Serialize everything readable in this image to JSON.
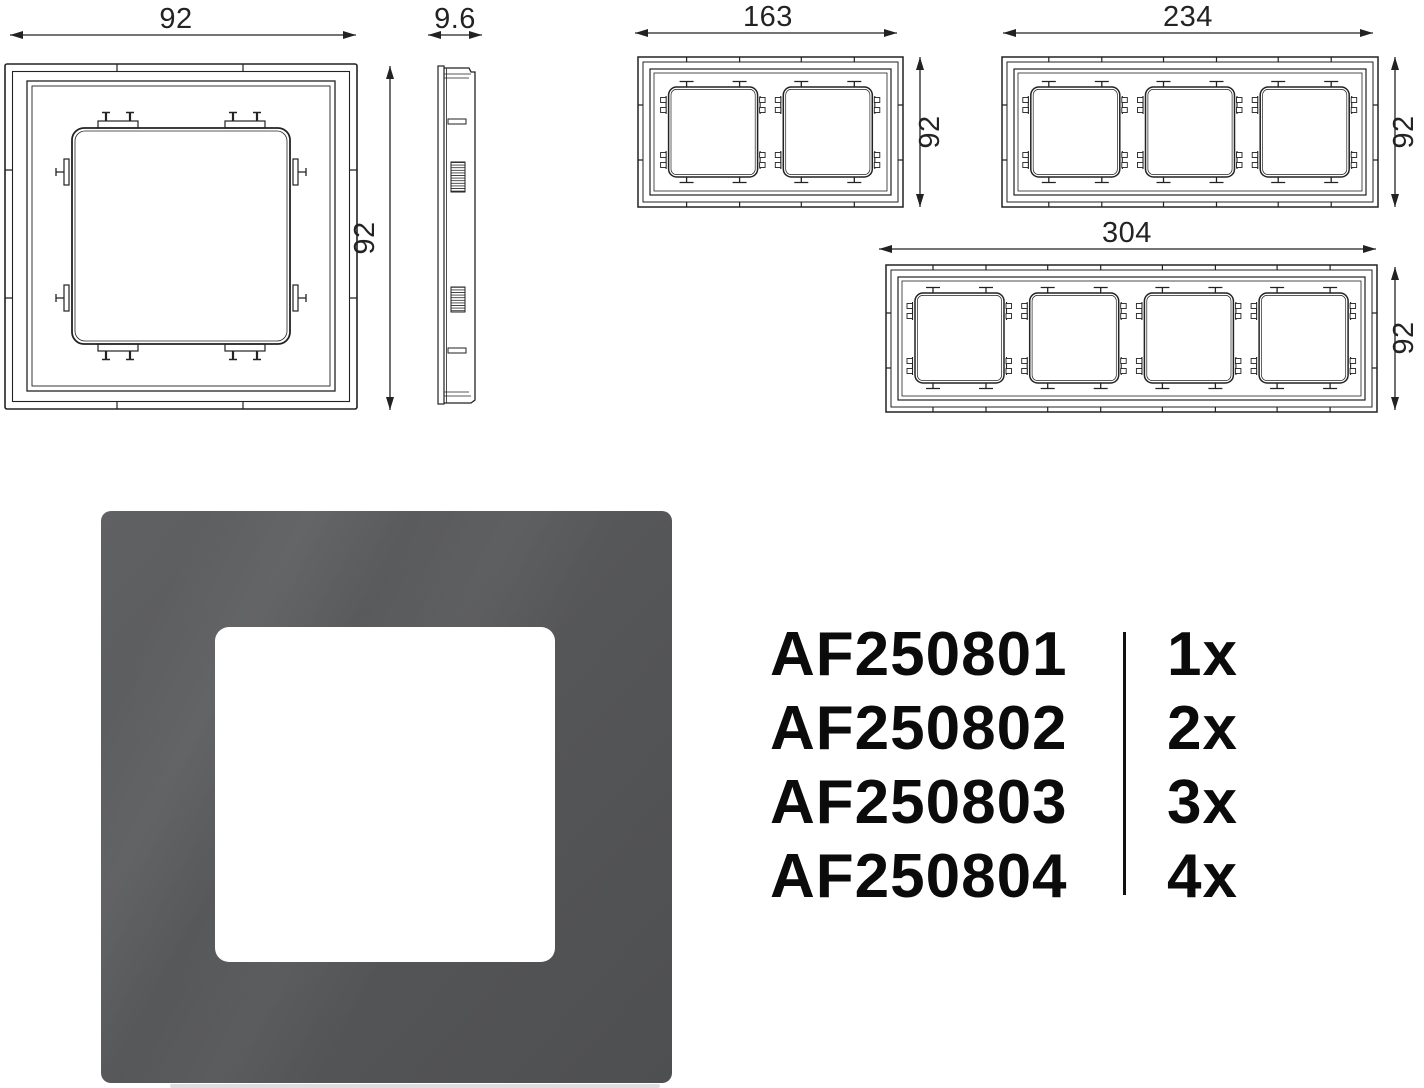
{
  "drawings": {
    "single": {
      "width_label": "92",
      "height_label": "92"
    },
    "side": {
      "depth_label": "9.6"
    },
    "two_gang": {
      "width_label": "163",
      "height_label": "92"
    },
    "three_gang": {
      "width_label": "234",
      "height_label": "92"
    },
    "four_gang": {
      "width_label": "304",
      "height_label": "92"
    }
  },
  "products": {
    "rows": [
      {
        "code": "AF250801",
        "qty": "1x"
      },
      {
        "code": "AF250802",
        "qty": "2x"
      },
      {
        "code": "AF250803",
        "qty": "3x"
      },
      {
        "code": "AF250804",
        "qty": "4x"
      }
    ]
  },
  "colors": {
    "frame_gray": "#565759",
    "line": "#222222"
  }
}
